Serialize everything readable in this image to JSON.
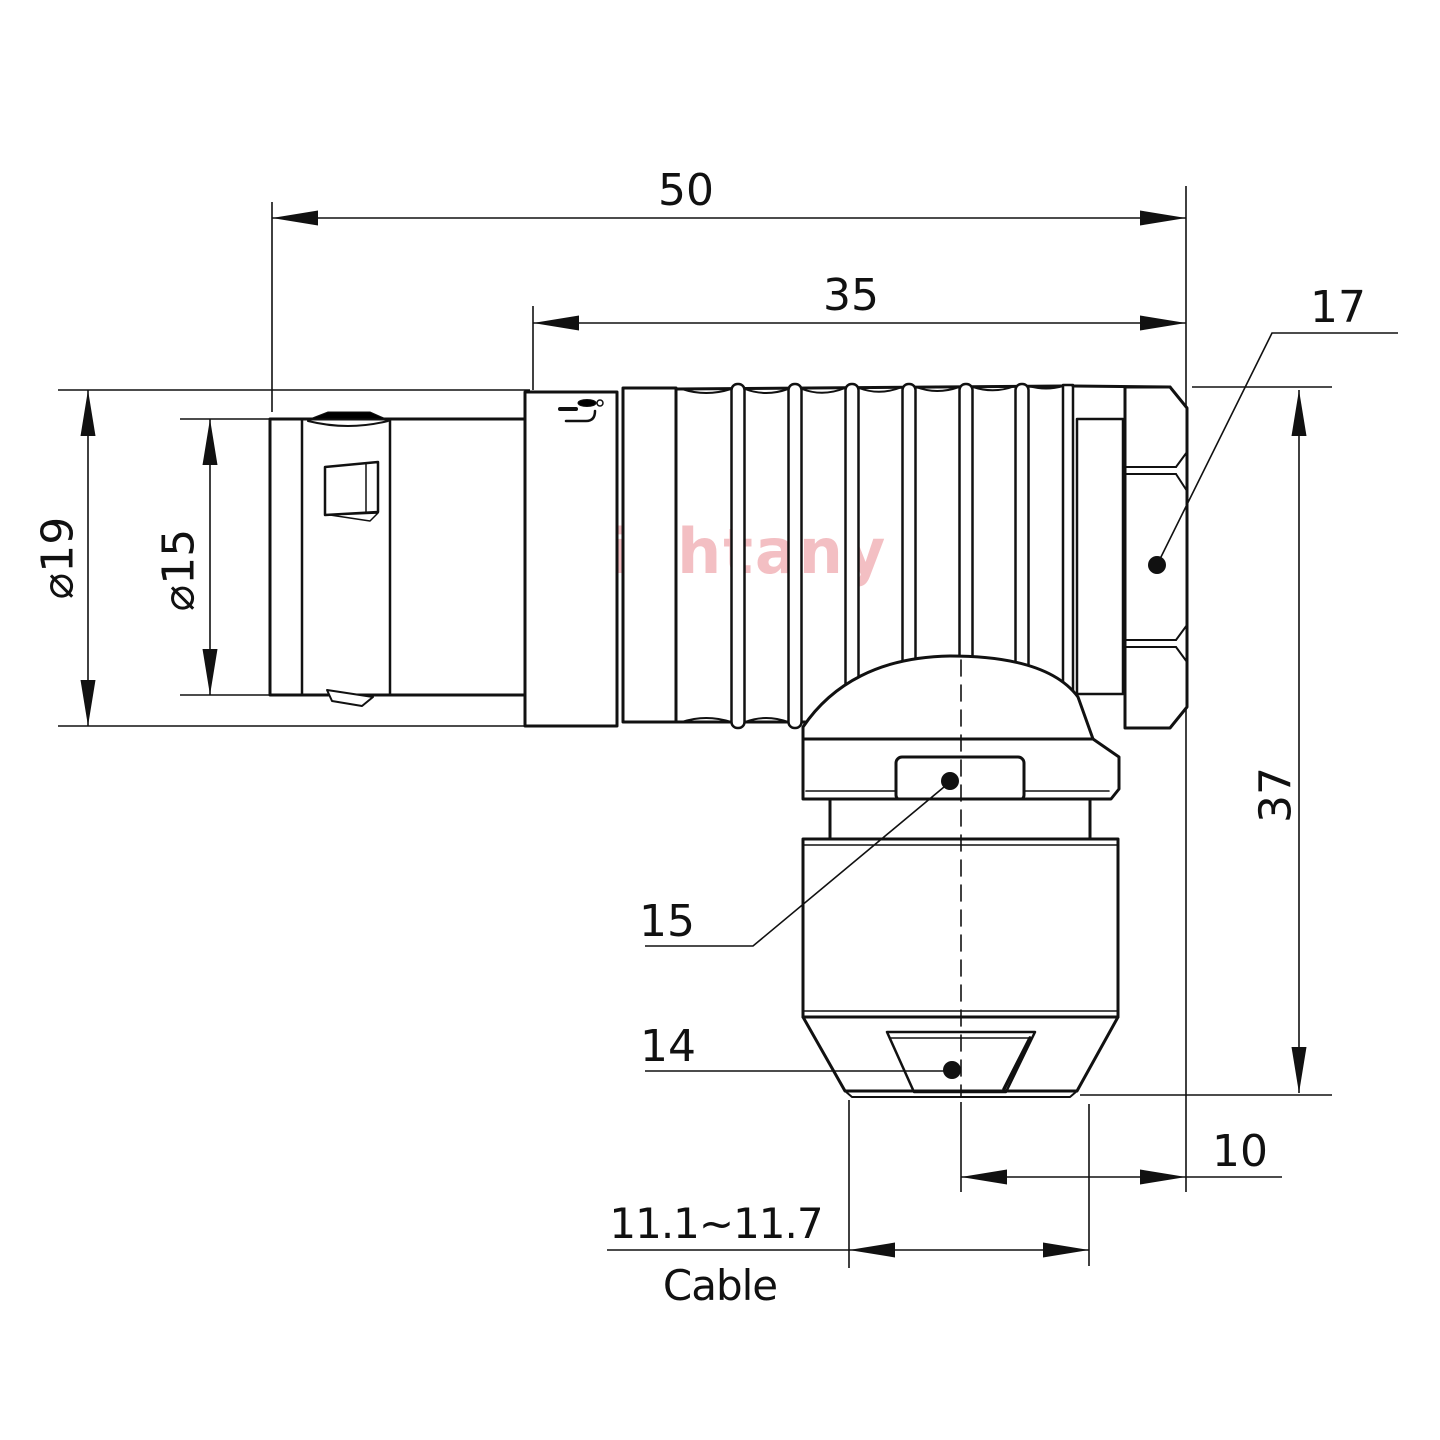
{
  "watermark": "Lightany",
  "dimensions": {
    "overall_length": "50",
    "body_length": "35",
    "nut_size": "17",
    "overall_height": "37",
    "outer_diameter": "⌀19",
    "front_diameter": "⌀15",
    "gland_size_15": "15",
    "collet_size_14": "14",
    "axis_offset": "10",
    "cable_range": "11.1~11.7",
    "cable_label": "Cable"
  }
}
